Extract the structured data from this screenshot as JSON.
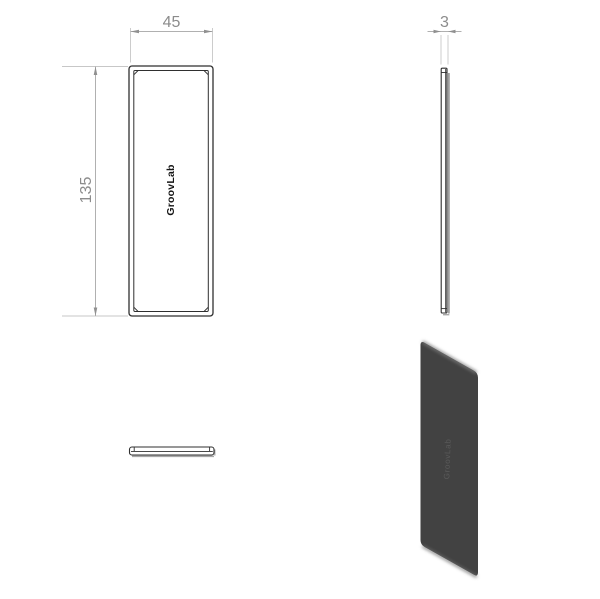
{
  "drawing": {
    "type": "technical-drawing",
    "dimensions": {
      "width_label": "45",
      "height_label": "135",
      "thickness_label": "3"
    },
    "front_view": {
      "logo_text": "GroovLab"
    },
    "iso_view": {
      "logo_text": "GroovLab"
    },
    "colors": {
      "background": "#ffffff",
      "outline": "#2f2f2f",
      "dimension_line": "#b0b0b0",
      "extension_line": "#c7c7c7",
      "dimension_arrow": "#909090",
      "dimension_text": "#8c8c8c",
      "shading_gray": "#a0a0a0",
      "iso_plate_fill": "#424242",
      "iso_edge_highlight": "#787878"
    }
  }
}
